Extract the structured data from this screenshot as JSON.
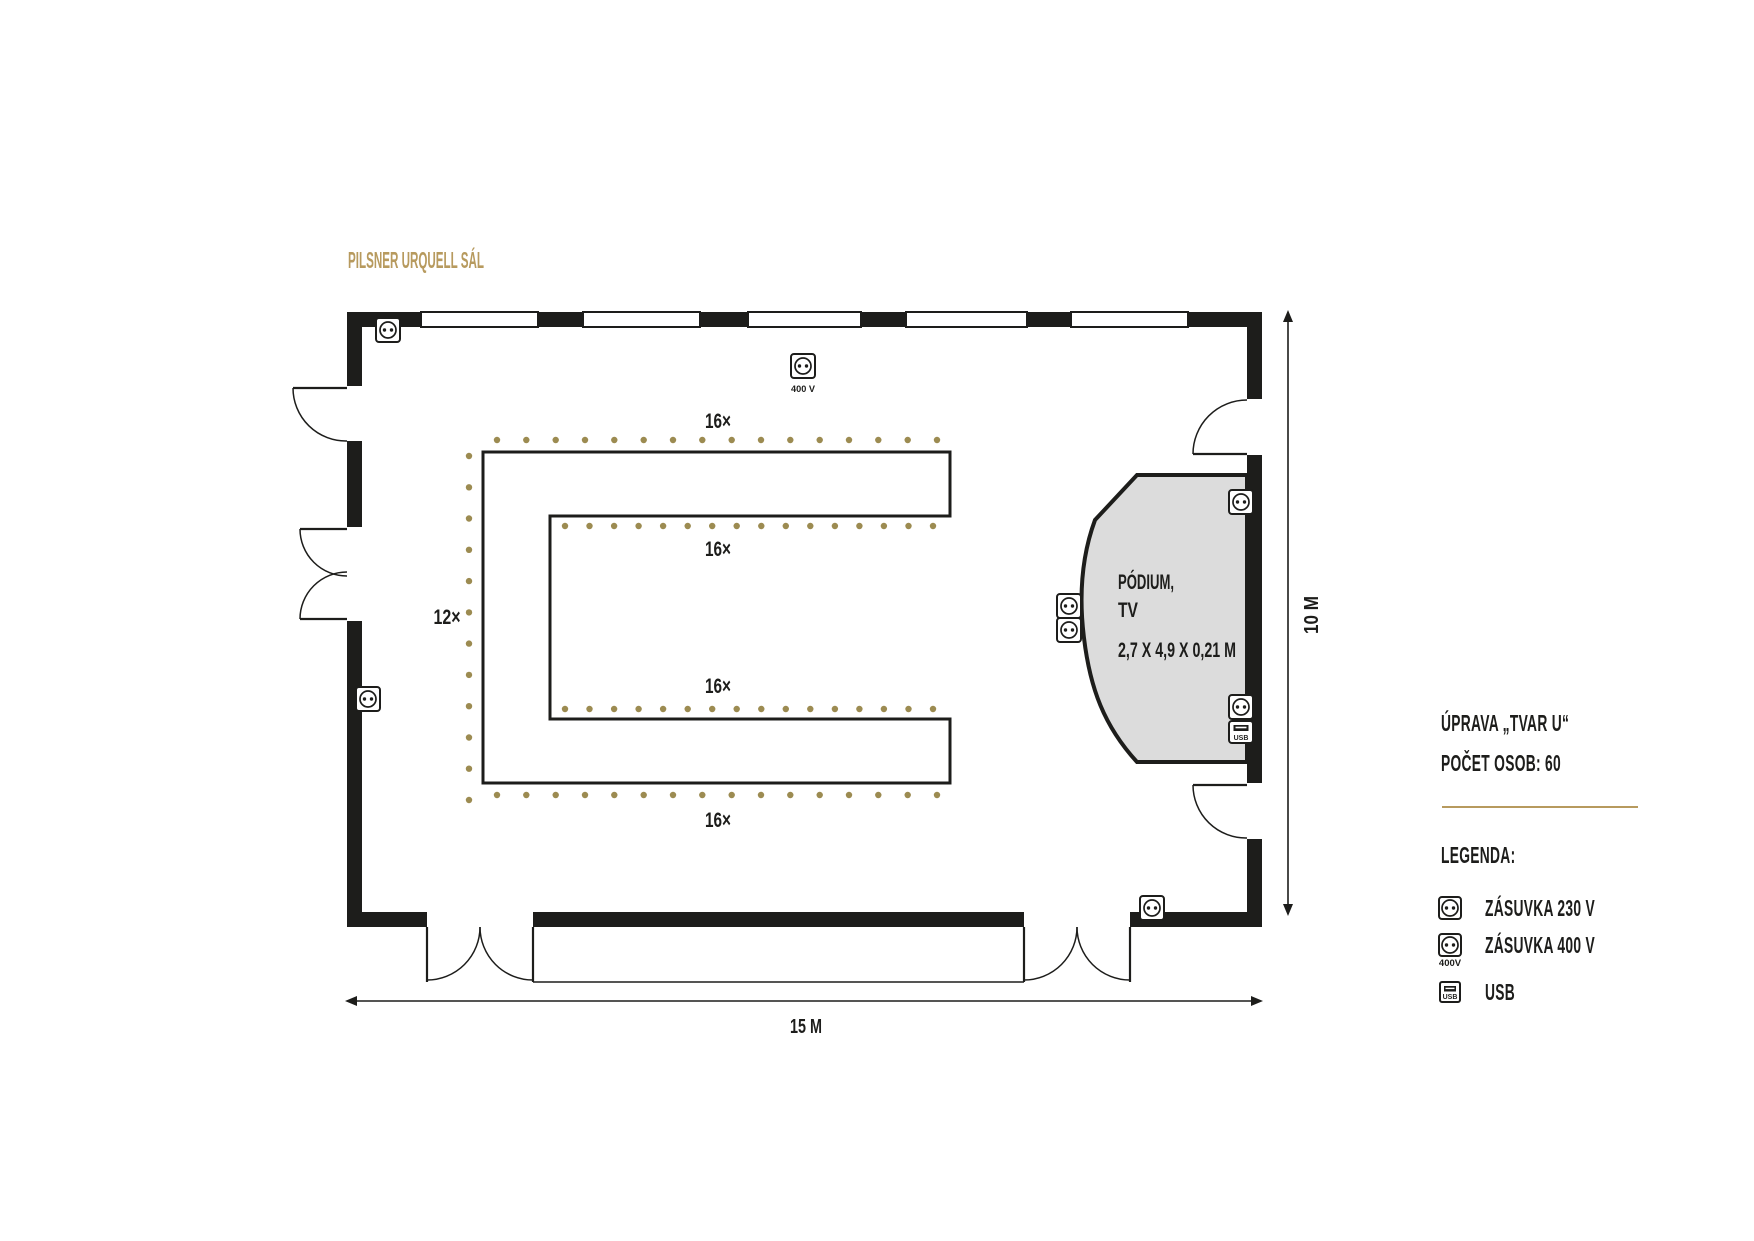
{
  "page": {
    "title": "PILSNER URQUELL SÁL"
  },
  "plan": {
    "seat_labels": {
      "top": "16×",
      "inner_top": "16×",
      "left": "12×",
      "inner_bottom": "16×",
      "bottom": "16×"
    },
    "podium": {
      "line1": "PÓDIUM,",
      "line2": "TV",
      "size": "2,7 X 4,9 X 0,21 M"
    },
    "socket_400v_caption": "400 V",
    "usb_icon_text": "USB",
    "dim_width": "15 M",
    "dim_height": "10 M",
    "windows": [
      [
        421,
        538
      ],
      [
        583,
        700
      ],
      [
        748,
        861
      ],
      [
        906,
        1027
      ],
      [
        1071,
        1188
      ]
    ],
    "chair_rows": [
      {
        "name": "outer-top",
        "count": 16,
        "x1": 497,
        "x2": 937,
        "y": 440
      },
      {
        "name": "inner-top",
        "count": 16,
        "x1": 565,
        "x2": 933,
        "y": 526
      },
      {
        "name": "inner-bottom",
        "count": 16,
        "x1": 565,
        "x2": 933,
        "y": 709
      },
      {
        "name": "outer-bottom",
        "count": 16,
        "x1": 497,
        "x2": 937,
        "y": 795
      }
    ],
    "chair_column": {
      "name": "outer-left",
      "count": 12,
      "x": 469,
      "y1": 456,
      "y2": 800
    },
    "sockets_230v": [
      [
        388,
        330
      ],
      [
        368,
        699
      ],
      [
        1241,
        502
      ],
      [
        1069,
        606
      ],
      [
        1069,
        630
      ],
      [
        1241,
        707
      ],
      [
        1152,
        908
      ]
    ],
    "socket_400v": [
      803,
      366
    ],
    "usb": [
      1241,
      732
    ]
  },
  "info": {
    "arrangement": "ÚPRAVA „TVAR U“",
    "capacity": "POČET OSOB: 60"
  },
  "legend": {
    "heading": "LEGENDA:",
    "items": [
      {
        "id": "socket-230v",
        "label": "ZÁSUVKA 230 V"
      },
      {
        "id": "socket-400v",
        "label": "ZÁSUVKA 400 V",
        "caption": "400V"
      },
      {
        "id": "usb",
        "label": "USB",
        "icon_text": "USB"
      }
    ]
  },
  "colors": {
    "ink": "#1d1d1b",
    "gold": "#b79a5e",
    "chair_dot": "#9c8b51",
    "podium_fill": "#dcdcdc"
  }
}
